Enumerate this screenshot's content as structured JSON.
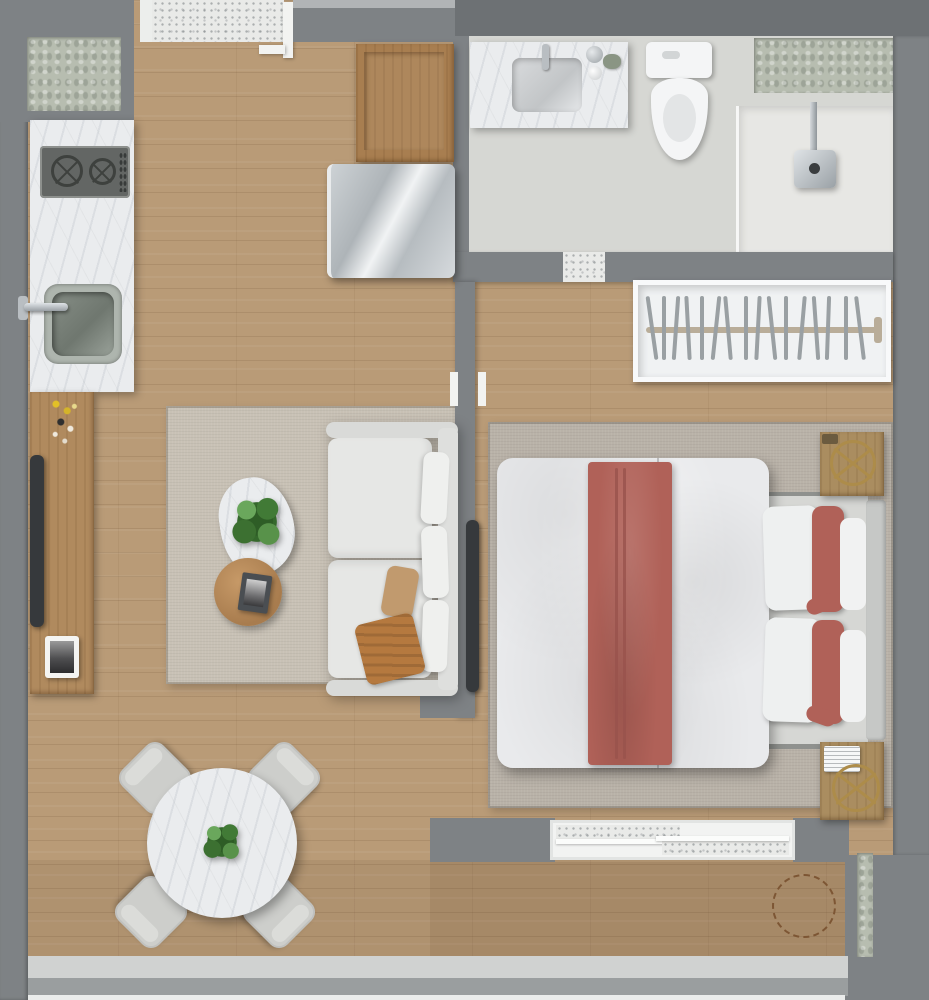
{
  "scene": {
    "kind": "apartment-floor-plan-3d-render",
    "view": "top-down",
    "rooms": [
      {
        "id": "kitchen",
        "label": "Kitchen",
        "items": [
          "corner frosted window",
          "marble countertop",
          "2-burner gas cooktop",
          "steel sink",
          "faucet",
          "wood upper cabinet",
          "stainless refrigerator"
        ]
      },
      {
        "id": "living-room",
        "label": "Living room",
        "items": [
          "beige area rug",
          "white sofa",
          "tan throw pillow",
          "orange throw blanket",
          "organic marble coffee table",
          "round wood side table",
          "green potted plant",
          "magazine",
          "wood media console",
          "flat tv on console",
          "framed portrait photo",
          "yellow flowers"
        ]
      },
      {
        "id": "dining-area",
        "label": "Dining area",
        "items": [
          "round marble dining table",
          "centerpiece plant",
          "four upholstered chairs"
        ]
      },
      {
        "id": "entry",
        "label": "Entry",
        "items": [
          "speckled corridor floor",
          "open entry door frame"
        ]
      },
      {
        "id": "bathroom",
        "label": "Bathroom",
        "items": [
          "marble vanity",
          "inset basin",
          "chrome faucet",
          "countertop accessories",
          "toilet",
          "walk-in shower",
          "wall shower head",
          "frosted window",
          "glass partition"
        ]
      },
      {
        "id": "closet",
        "label": "Closet",
        "items": [
          "open white wardrobe",
          "hanging rail",
          "hangers"
        ]
      },
      {
        "id": "bedroom",
        "label": "Bedroom",
        "items": [
          "grey area rug",
          "double bed",
          "white duvet",
          "terracotta bed runner",
          "white pillows",
          "terracotta accent pillows",
          "upholstered headboard",
          "two wood nightstands",
          "brass decorative trays",
          "white notepad",
          "wall-mounted tv",
          "sliding glass door to balcony"
        ]
      },
      {
        "id": "balcony",
        "label": "Balcony / window wall",
        "items": [
          "wood deck floor",
          "dashed placement circle",
          "frosted slot window",
          "full-width window frame"
        ]
      }
    ],
    "counts": {
      "dining_chairs": 4,
      "closet_hangers": 16,
      "cooktop_burners": 2,
      "bed_white_pillows": 4,
      "bed_accent_pillows": 2,
      "nightstands": 2
    }
  },
  "colors": {
    "wall": "#7e8285",
    "wall_dark": "#6d7174",
    "wall_light": "#b1b4b6",
    "wood_floor": "#b99b77",
    "wood_furniture": "#ae8356",
    "rug_living": "#c8c1b5",
    "rug_bedroom": "#b9b2a8",
    "marble": "#eaecee",
    "bathroom_floor": "#d6d7d3",
    "shower_floor": "#e7e7e4",
    "frosted_glass": "#b7bdb0",
    "speckle_floor": "#e9eae8",
    "closet_white": "#f0f2f3",
    "fixture_white": "#f4f5f6",
    "sofa_white": "#e6e7e5",
    "duvet_white": "#e9eaec",
    "accent_red": "#b06158",
    "accent_red_dark": "#98534c",
    "pillow_tan": "#c19a6e",
    "throw_orange": "#b5793f",
    "plant_green": "#35682c",
    "brass": "#ad8c4a",
    "chrome": "#b9bec2",
    "tv_black": "#36393c",
    "fridge_silver": "#c6cbce",
    "dashed_marker": "#7d5634"
  }
}
